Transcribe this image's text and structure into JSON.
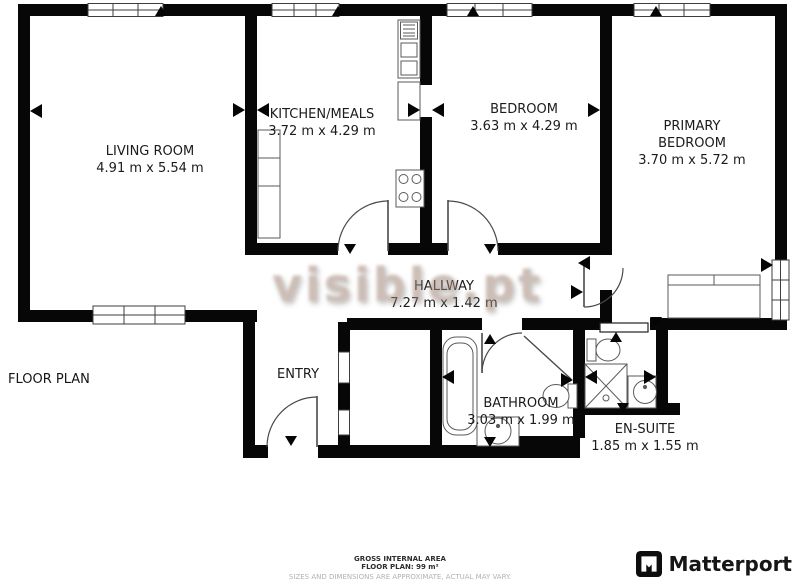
{
  "watermark": {
    "text": "visible.pt"
  },
  "plan_label": "FLOOR PLAN",
  "rooms": [
    {
      "id": "living-room",
      "name": "LIVING ROOM",
      "dims": "4.91 m x 5.54 m"
    },
    {
      "id": "kitchen-meals",
      "name": "KITCHEN/MEALS",
      "dims": "3.72 m x 4.29 m"
    },
    {
      "id": "bedroom",
      "name": "BEDROOM",
      "dims": "3.63 m x 4.29 m"
    },
    {
      "id": "primary-bedroom",
      "name": "PRIMARY BEDROOM",
      "dims": "3.70 m x 5.72 m"
    },
    {
      "id": "hallway",
      "name": "HALLWAY",
      "dims": "7.27 m x 1.42 m"
    },
    {
      "id": "entry",
      "name": "ENTRY",
      "dims": ""
    },
    {
      "id": "bathroom",
      "name": "BATHROOM",
      "dims": "3.03 m x 1.99 m"
    },
    {
      "id": "en-suite",
      "name": "EN-SUITE",
      "dims": "1.85 m x 1.55 m"
    }
  ],
  "footer": {
    "area_title": "GROSS INTERNAL AREA",
    "area_value": "FLOOR PLAN: 99 m²",
    "disclaimer": "SIZES AND DIMENSIONS ARE APPROXIMATE, ACTUAL MAY VARY.",
    "brand": "Matterport"
  },
  "colors": {
    "wall": "#070707",
    "fixture_stroke": "#5a5a5a",
    "watermark": "#a3897a"
  }
}
